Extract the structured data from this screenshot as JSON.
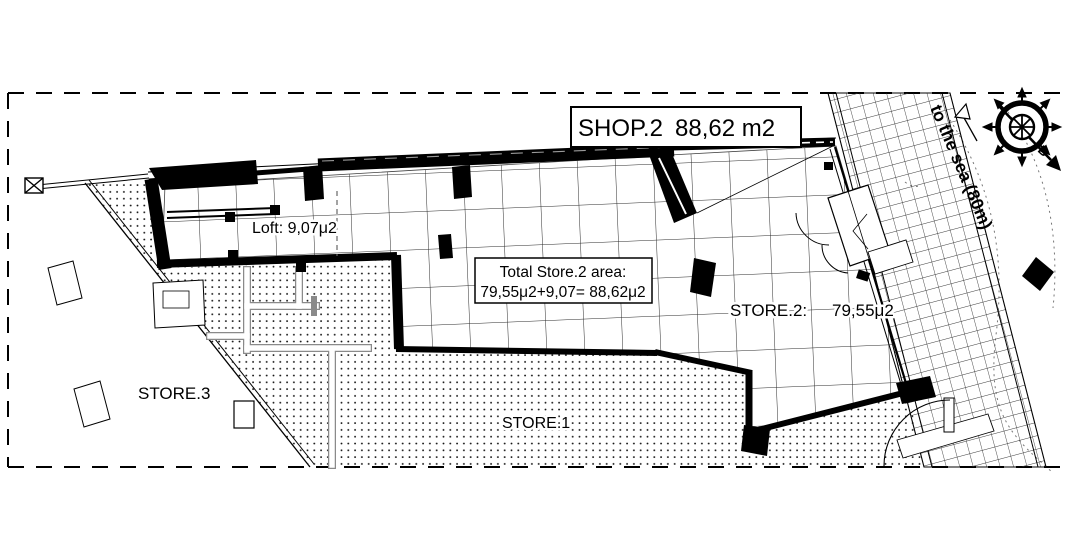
{
  "plan": {
    "title": {
      "name": "SHOP.2",
      "area": "88,62 m2"
    },
    "total_box": {
      "line1": "Total Store.2 area:",
      "line2": "79,55μ2+9,07= 88,62μ2"
    },
    "rooms": {
      "loft": {
        "label": "Loft: 9,07μ2"
      },
      "store2": {
        "label": "STORE.2:",
        "area": "79,55μ2"
      },
      "store1": {
        "label": "STORE.1"
      },
      "store3": {
        "label": "STORE.3"
      }
    },
    "annotations": {
      "sea_direction": "to the sea (80m)",
      "compass_north": "B"
    },
    "icons": {
      "compass": "compass-rose-icon",
      "north_arrow": "north-arrow-icon",
      "sea_arrow": "sea-direction-arrow-icon"
    },
    "colors": {
      "ink": "#000000",
      "paper": "#ffffff",
      "grid_line": "#2b2b2b",
      "partition_gray": "#8a8a8a"
    }
  }
}
